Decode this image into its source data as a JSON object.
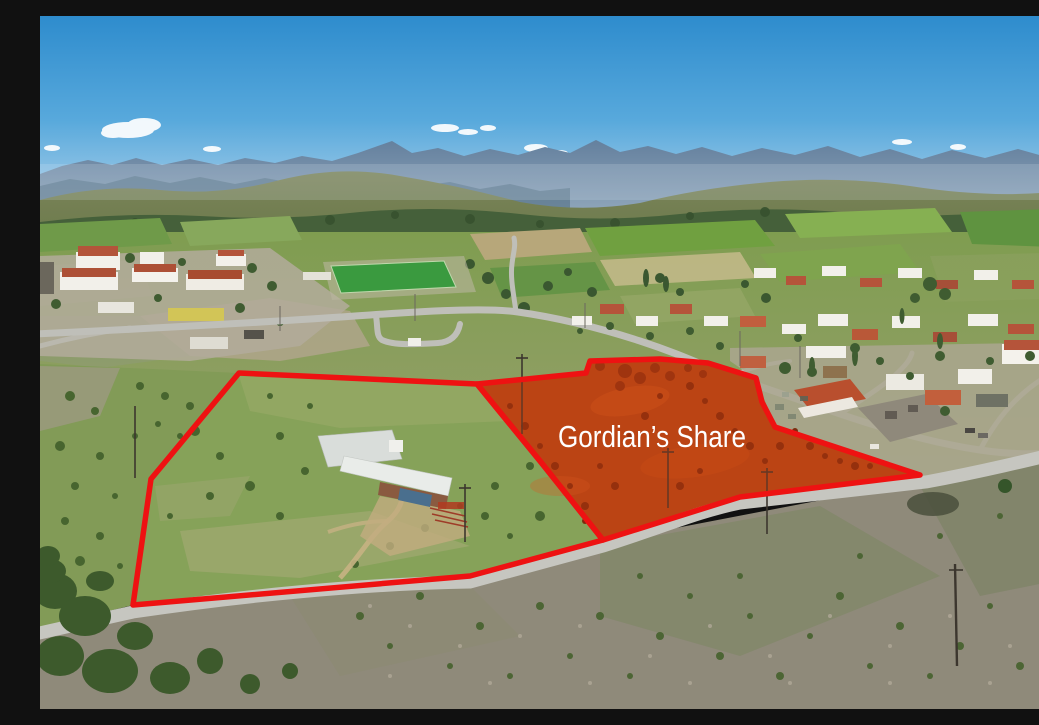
{
  "image": {
    "alt": "Aerial drone photograph of a hillside village with mountain ridges on the horizon; two adjoining land parcels are outlined in thick red and the right-hand parcel, shaded red-orange soil, carries a white label"
  },
  "annotations": {
    "parcel_label": "Gordian’s Share",
    "outline_color": "#ee1212",
    "highlight_color": "#d13c0e",
    "label_color": "#ffffff"
  },
  "palette": {
    "sky_top": "#2e8ccd",
    "sky_horizon": "#a9cfe9",
    "mountain_haze": "#64809e",
    "hill_olive": "#76814f",
    "field_green": "#86a356",
    "red_soil": "#b24818",
    "road_gray": "#c6c6c0",
    "scrub_gray": "#8f8a7a"
  }
}
